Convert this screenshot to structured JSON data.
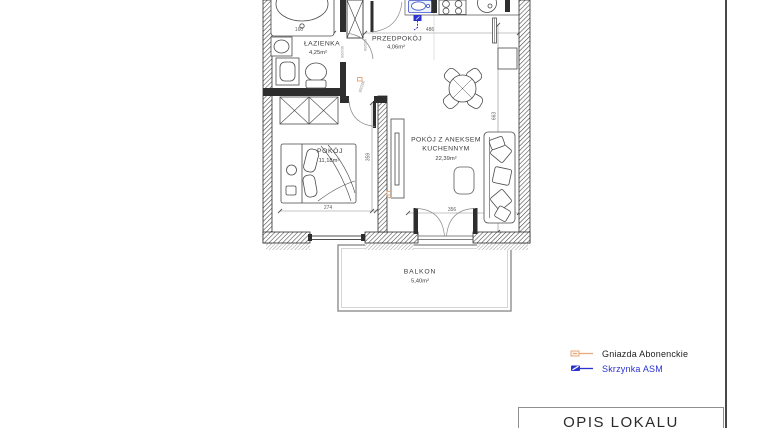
{
  "plan": {
    "rooms": {
      "lazienka": {
        "name": "ŁAZIENKA",
        "area": "4,25m²"
      },
      "przedpokoj": {
        "name": "PRZEDPOKÓJ",
        "area": "4,06m²"
      },
      "pokoj": {
        "name": "POKÓJ",
        "area": "11,18m²"
      },
      "salon": {
        "name_line1": "POKÓJ Z ANEKSEM",
        "name_line2": "KUCHENNYM",
        "area": "22,39m²"
      },
      "balkon": {
        "name": "BALKON",
        "area": "5,40m²"
      }
    },
    "dimensions": {
      "bathtub_width": "160",
      "living_width": "486",
      "bedroom_width": "274",
      "bedroom_depth": "359",
      "living_depth": "663",
      "balcony_door_width": "356",
      "bathroom_door": "90/20h",
      "bedroom_door": "90/20h",
      "entrance_door": "90/20h"
    }
  },
  "legend": {
    "items": [
      {
        "label": "Gniazda Abonenckie"
      },
      {
        "label": "Skrzynka ASM"
      }
    ]
  },
  "title_block": {
    "title": "OPIS LOKALU"
  },
  "colors": {
    "wall": "#3a3a3a",
    "line": "#4a4a4a",
    "dimension": "#6a6a6a",
    "accent_orange": "#e7a87d",
    "accent_blue": "#2a32cf"
  }
}
